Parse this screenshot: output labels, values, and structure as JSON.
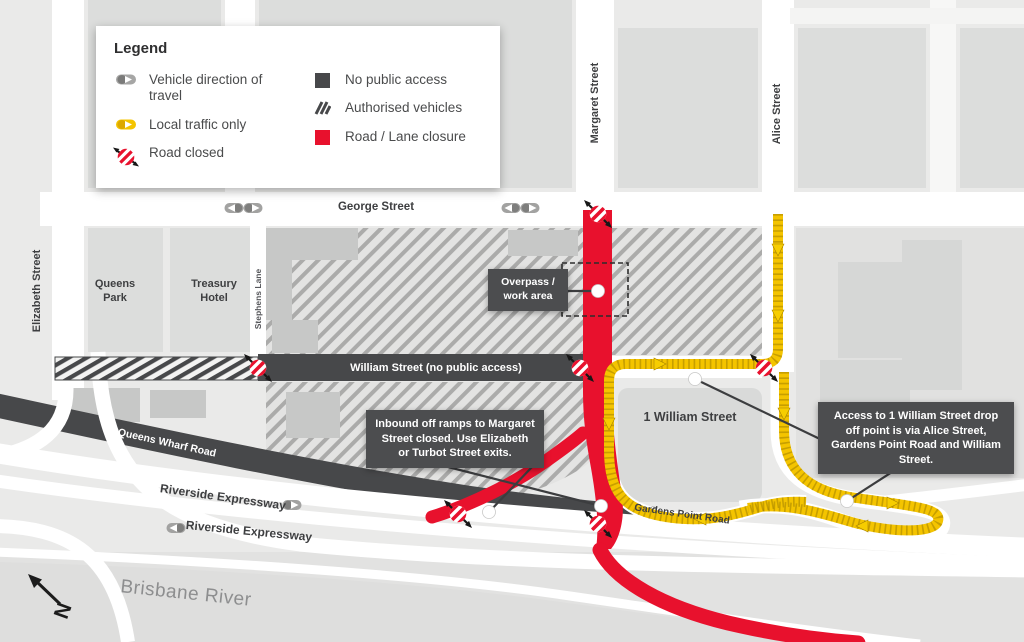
{
  "map": {
    "legend": {
      "title": "Legend",
      "items": [
        {
          "id": "vehicle-direction",
          "label": "Vehicle direction of travel"
        },
        {
          "id": "local-traffic",
          "label": "Local traffic only"
        },
        {
          "id": "road-closed",
          "label": "Road closed"
        },
        {
          "id": "no-public-access",
          "label": "No public access"
        },
        {
          "id": "authorised-vehicles",
          "label": "Authorised vehicles"
        },
        {
          "id": "road-lane-closure",
          "label": "Road / Lane closure"
        }
      ]
    },
    "streets": {
      "george": "George Street",
      "elizabeth": "Elizabeth Street",
      "margaret": "Margaret Street",
      "alice": "Alice Street",
      "stephens_lane": "Stephens Lane",
      "william": "William Street (no public access)",
      "queens_wharf": "Queens Wharf Road",
      "riverside_upper": "Riverside Expressway",
      "riverside_lower": "Riverside Expressway",
      "gardens_point": "Gardens Point Road"
    },
    "places": {
      "queens_park": "Queens Park",
      "treasury_hotel": "Treasury Hotel",
      "one_william_street": "1 William Street",
      "brisbane_river": "Brisbane River"
    },
    "callouts": {
      "overpass": "Overpass / work area",
      "inbound_ramps": "Inbound off ramps to Margaret Street closed. Use Elizabeth or Turbot Street exits.",
      "one_william_access": "Access to 1 William Street drop off point is via Alice Street, Gardens Point Road and William Street."
    },
    "compass": {
      "north": "N"
    },
    "colors": {
      "closure_red": "#e8112d",
      "local_traffic_yellow": "#f4c400",
      "no_access_dark": "#47484a",
      "background": "#eaeae9"
    }
  }
}
